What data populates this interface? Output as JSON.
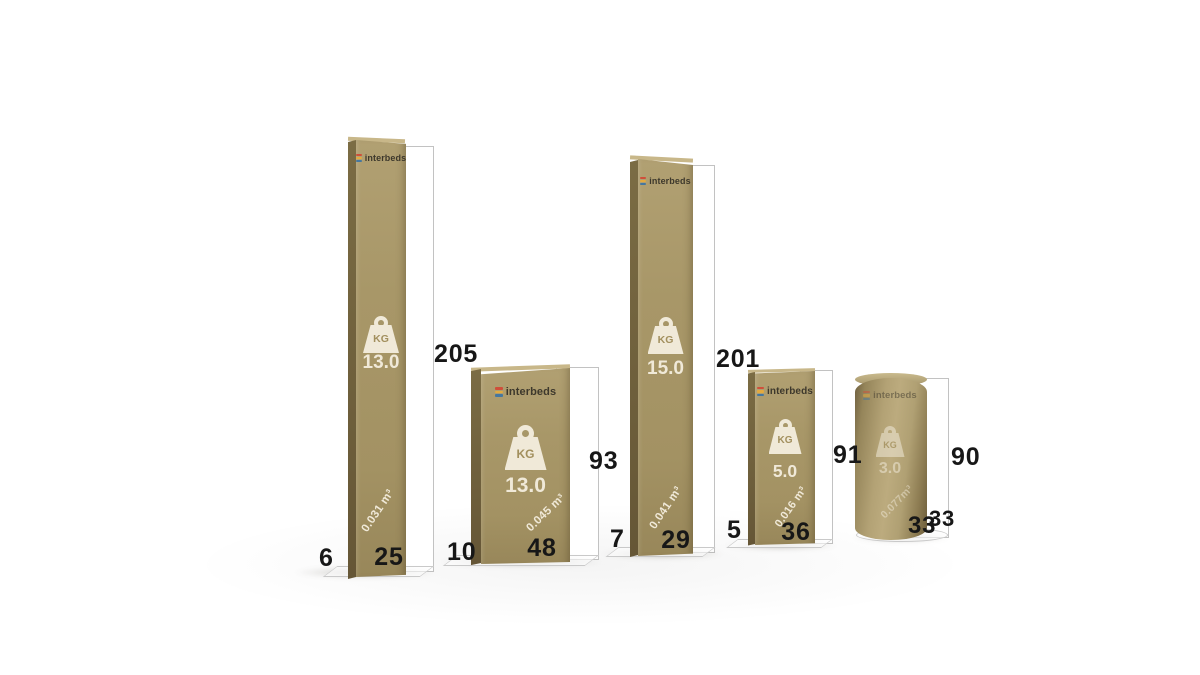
{
  "scene": {
    "description": "Package size comparison 3D render",
    "background": "#ffffff"
  },
  "brand": {
    "name": "interbeds",
    "logo_bar_colors": [
      "#cf4f3a",
      "#e3aa3f",
      "#45779f"
    ]
  },
  "units": {
    "kg_label": "KG"
  },
  "colors": {
    "carton": "#a79566",
    "carton_dark_side": "#75663f",
    "print_cream": "#f0e9d8",
    "dimension_text": "#171717",
    "frame_border": "#c2c2c2"
  },
  "packages": [
    {
      "shape": "box",
      "weight": "13.0",
      "volume": "0.031 m³",
      "height": "205",
      "width": "25",
      "depth": "6"
    },
    {
      "shape": "box",
      "weight": "13.0",
      "volume": "0.045 m³",
      "height": "93",
      "width": "48",
      "depth": "10"
    },
    {
      "shape": "box",
      "weight": "15.0",
      "volume": "0.041 m³",
      "height": "201",
      "width": "29",
      "depth": "7"
    },
    {
      "shape": "box",
      "weight": "5.0",
      "volume": "0.016 m³",
      "height": "91",
      "width": "36",
      "depth": "5"
    },
    {
      "shape": "cylinder",
      "weight": "3.0",
      "volume": "0.077m³",
      "height": "90",
      "width": "33",
      "depth": "33"
    }
  ]
}
